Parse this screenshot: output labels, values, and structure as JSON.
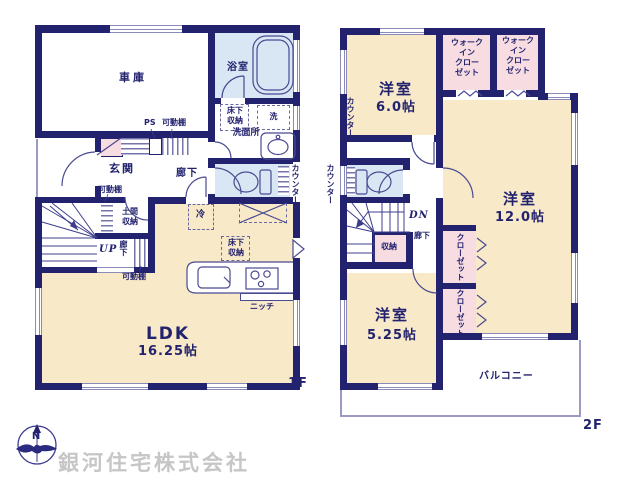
{
  "floor1": {
    "garage": "車庫",
    "bathroom": "浴室",
    "underfloor_wash": "床下\n収納",
    "laundry": "洗",
    "washroom": "洗面所",
    "counter": "カウンター",
    "ps": "PS",
    "shelf_top": "可動棚",
    "entrance": "玄関",
    "hallway": "廊下",
    "shelf_entrance": "可動棚",
    "doma_storage": "土間\n収納",
    "up": "UP",
    "hallway_vertical": "廊下",
    "shelf_hall": "可動棚",
    "fridge": "冷",
    "underfloor_kitchen": "床下\n収納",
    "niche": "ニッチ",
    "ldk_name": "LDK",
    "ldk_size": "16.25帖",
    "floor_label": "1F"
  },
  "floor2": {
    "room6_name": "洋室",
    "room6_size": "6.0帖",
    "counter_room6": "カウンター",
    "wic1": "ウォーク\nイン\nクロー\nゼット",
    "wic2": "ウォーク\nイン\nクロー\nゼット",
    "room12_name": "洋室",
    "room12_size": "12.0帖",
    "counter_toilet": "カウンター",
    "dn": "DN",
    "hallway": "廊下",
    "storage": "収納",
    "closet1": "クローゼット",
    "closet2": "クローゼット",
    "room525_name": "洋室",
    "room525_size": "5.25帖",
    "balcony": "バルコニー",
    "floor_label": "2F"
  },
  "footer": {
    "company": "銀河住宅株式会社",
    "compass_north": "N"
  },
  "colors": {
    "wall": "#22226e",
    "floor_cream": "#f8e9c8",
    "floor_blue": "#d9e6f4",
    "closet_pink": "#f7dde2",
    "linework": "#4a4a92",
    "watermark": "#c6c6c6"
  }
}
